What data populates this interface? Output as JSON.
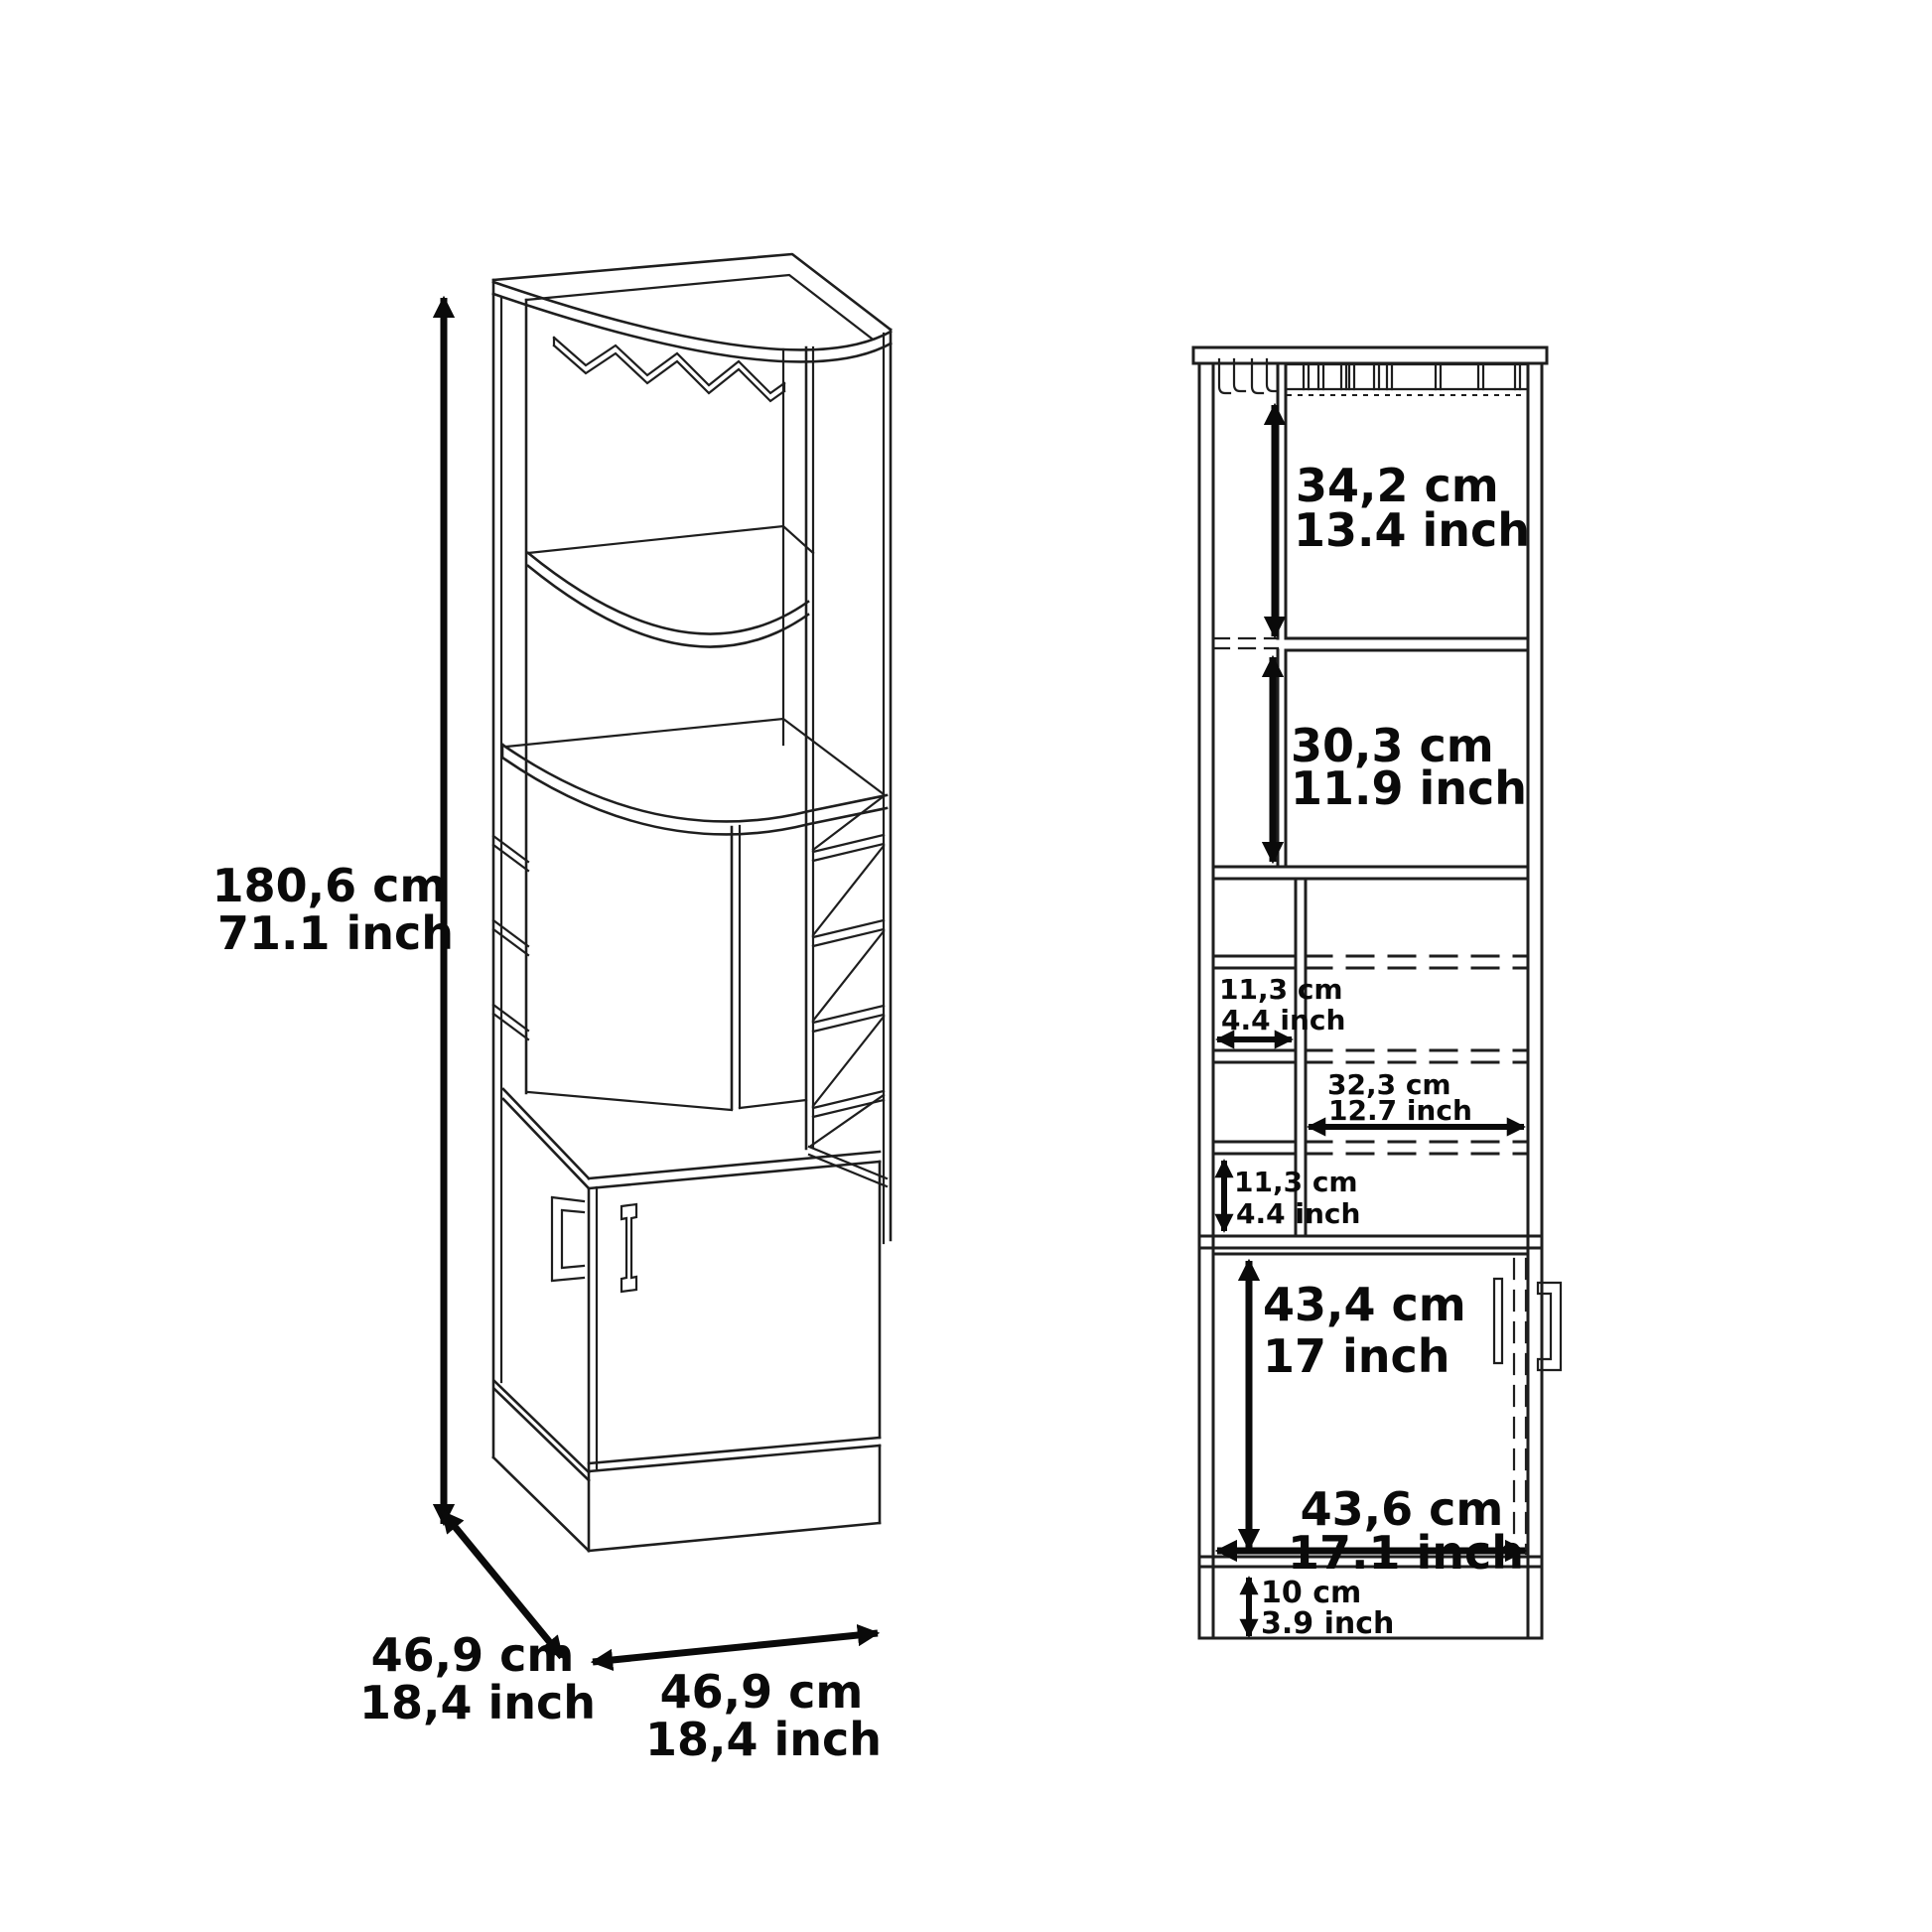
{
  "colors": {
    "background": "#ffffff",
    "line": "#1e1e1e",
    "dimension": "#0a0a0a"
  },
  "perspective_view": {
    "height": {
      "cm": "180,6 cm",
      "inch": "71.1 inch"
    },
    "depth": {
      "cm": "46,9 cm",
      "inch": "18,4 inch"
    },
    "width": {
      "cm": "46,9 cm",
      "inch": "18,4 inch"
    }
  },
  "front_view": {
    "upper_section_height": {
      "cm": "34,2 cm",
      "inch": "13.4 inch"
    },
    "second_section_height": {
      "cm": "30,3 cm",
      "inch": "11.9 inch"
    },
    "cubby_width": {
      "cm": "11,3 cm",
      "inch": "4.4 inch"
    },
    "open_shelf_width": {
      "cm": "32,3 cm",
      "inch": "12.7 inch"
    },
    "cubby_height": {
      "cm": "11,3 cm",
      "inch": "4.4 inch"
    },
    "door_section_height": {
      "cm": "43,4 cm",
      "inch": "17 inch"
    },
    "cabinet_width": {
      "cm": "43,6 cm",
      "inch": "17.1 inch"
    },
    "base_height": {
      "cm": "10 cm",
      "inch": "3.9 inch"
    }
  }
}
